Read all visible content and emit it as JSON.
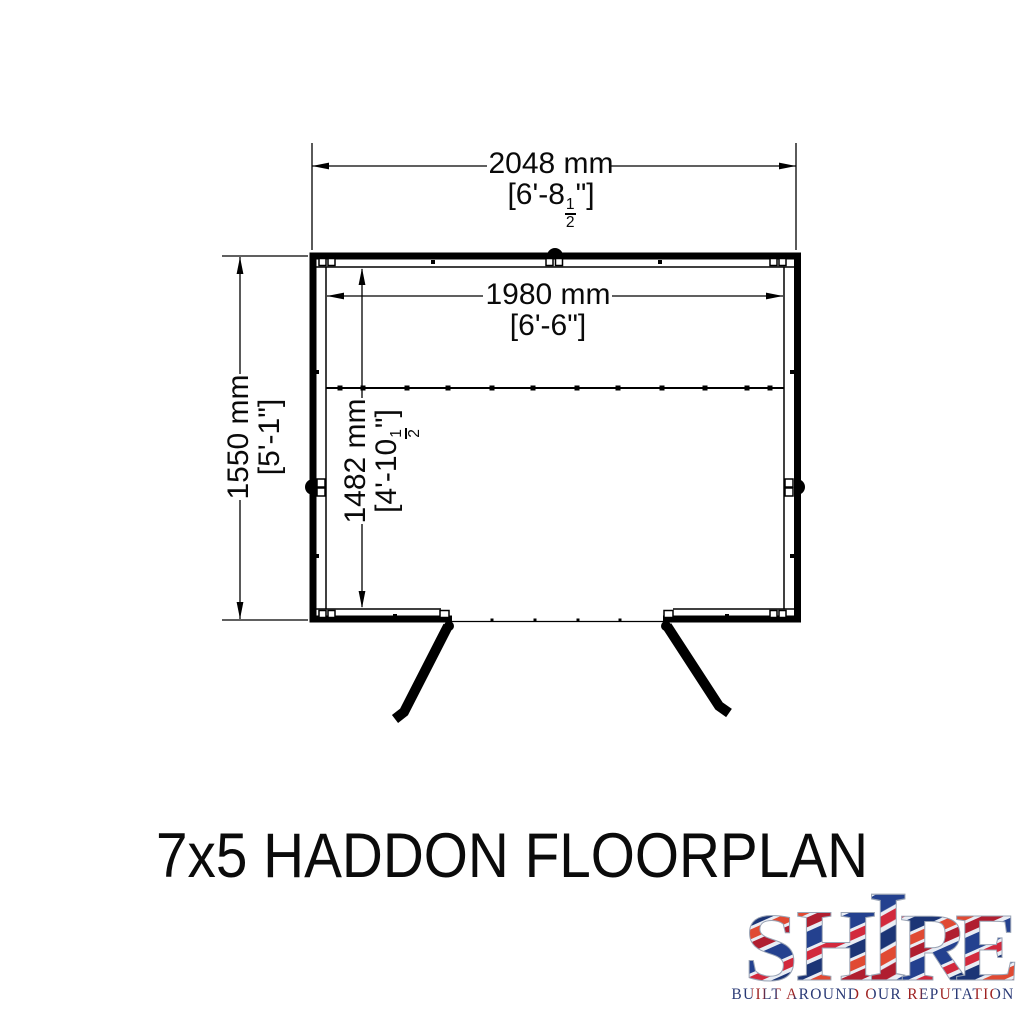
{
  "title": "7x5 HADDON FLOORPLAN",
  "dimensions": {
    "outer_width": {
      "metric": "2048 mm",
      "imperial_open": "[6'-8",
      "frac": {
        "num": "1",
        "den": "2"
      },
      "imperial_close": "\"]"
    },
    "inner_width": {
      "metric": "1980 mm",
      "imperial": "[6'-6\"]"
    },
    "outer_depth": {
      "metric": "1550 mm",
      "imperial": "[5'-1\"]"
    },
    "inner_depth": {
      "metric": "1482 mm",
      "imperial_open": "[4'-10",
      "frac": {
        "num": "1",
        "den": "2"
      },
      "imperial_close": "\"]"
    }
  },
  "logo": {
    "letters": [
      "S",
      "H",
      "I",
      "R",
      "E"
    ],
    "tagline": "BUILT AROUND OUR REPUTATION",
    "flag_blue": "#24418f",
    "flag_red": "#cf2137",
    "flag_dark_red": "#b01e30",
    "flag_orange_red": "#e04a33",
    "tagline_navy": "#2a3a76",
    "tagline_red": "#9e2221"
  },
  "drawing": {
    "ink": "#000000"
  }
}
